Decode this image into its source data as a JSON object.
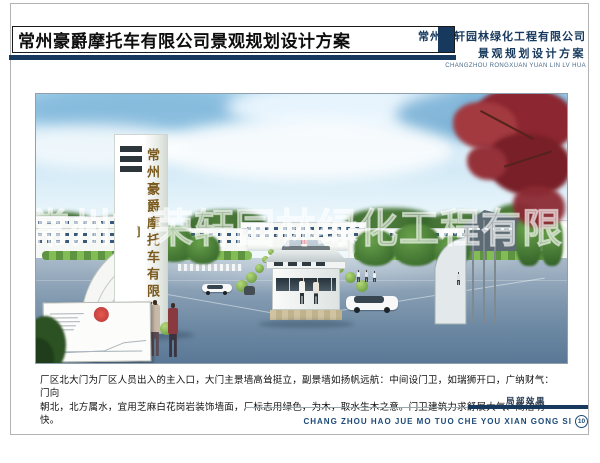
{
  "header": {
    "title": "常州豪爵摩托车有限公司景观规划设计方案",
    "company_line1": "常州荣轩园林绿化工程有限公司",
    "company_line2": "景观规划设计方案",
    "company_caption": "CHANGZHOU RONGXUAN YUAN LIN LV HUA"
  },
  "rendering": {
    "gate_sign": "常州豪爵摩托车有限公司",
    "watermark": "常州市荣轩园林绿化工程有限公司"
  },
  "description": {
    "line1": "厂区北大门为厂区人员出入的主入口，大门主景墙高耸挺立，副景墙如扬帆远航：中间设门卫，如瑞狮开口，广纳财气：门向",
    "line2": "朝北，北方属水，宜用芝麻白花岗岩装饰墙面，厂标志用绿色，为木，取水生木之意。门卫建筑力求舒展大气、简洁明快。"
  },
  "footer": {
    "label": "局部效果",
    "pinyin": "CHANG ZHOU HAO JUE MO TUO CHE YOU XIAN GONG SI",
    "page_number": "10"
  },
  "colors": {
    "navy": "#16395d",
    "seal_red": "#c02424",
    "sign_gold": "#7a5a1e"
  }
}
